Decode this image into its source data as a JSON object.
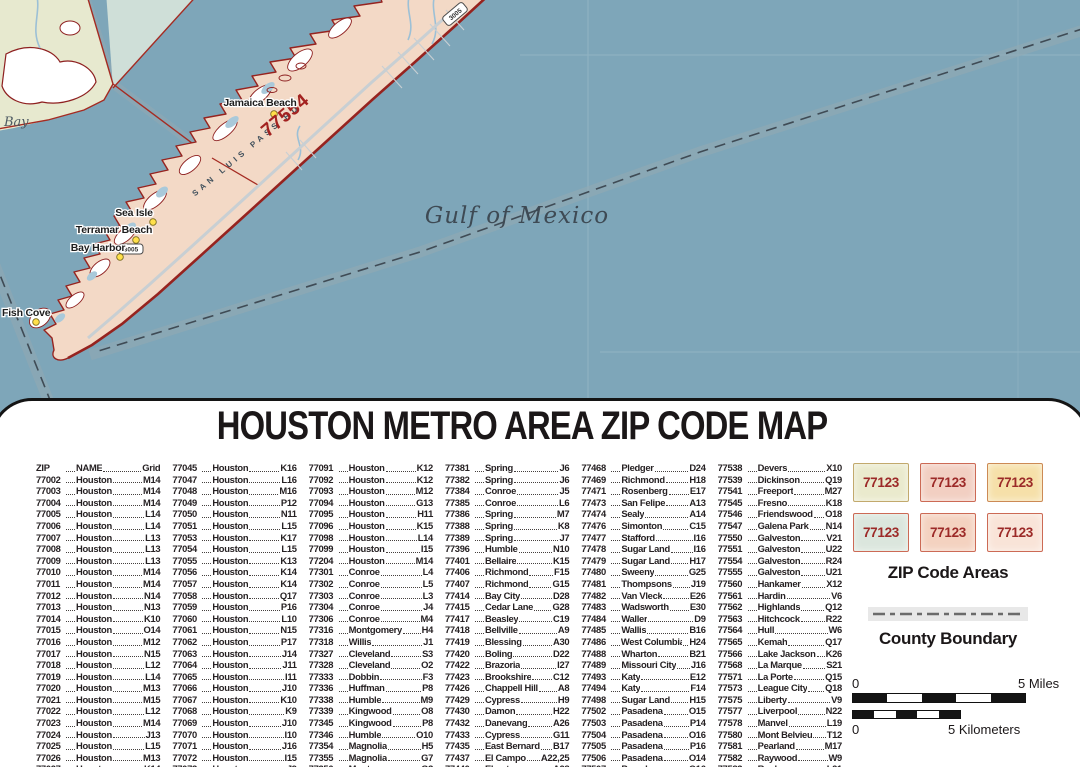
{
  "map": {
    "labels": {
      "gulf": "Gulf of Mexico",
      "bay": "Bay",
      "zip_area": "77554",
      "road": "SAN LUIS PASS RD",
      "route_shield": "3005",
      "towns": [
        "Jamaica Beach",
        "Sea Isle",
        "Terramar Beach",
        "Bay Harbor",
        "Fish Cove"
      ]
    },
    "colors": {
      "water": "#7ea6b9",
      "island": "#f3d9c6",
      "coastline": "#96231f",
      "mainland": "#e7e9cf",
      "bay_overlay": "#cfdfd8"
    }
  },
  "panel": {
    "title": "HOUSTON METRO AREA ZIP CODE MAP"
  },
  "zip_index": {
    "header": {
      "zip": "ZIP",
      "name": "NAME",
      "grid": "Grid"
    },
    "columns": [
      {
        "rows": [
          {
            "zip": "77002",
            "name": "Houston",
            "grid": "M14"
          },
          {
            "zip": "77003",
            "name": "Houston",
            "grid": "M14"
          },
          {
            "zip": "77004",
            "name": "Houston",
            "grid": "M14"
          },
          {
            "zip": "77005",
            "name": "Houston",
            "grid": "L14"
          },
          {
            "zip": "77006",
            "name": "Houston",
            "grid": "L14"
          },
          {
            "zip": "77007",
            "name": "Houston",
            "grid": "L13"
          },
          {
            "zip": "77008",
            "name": "Houston",
            "grid": "L13"
          },
          {
            "zip": "77009",
            "name": "Houston",
            "grid": "L13"
          },
          {
            "zip": "77010",
            "name": "Houston",
            "grid": "M14"
          },
          {
            "zip": "77011",
            "name": "Houston",
            "grid": "M14"
          },
          {
            "zip": "77012",
            "name": "Houston",
            "grid": "N14"
          },
          {
            "zip": "77013",
            "name": "Houston",
            "grid": "N13"
          },
          {
            "zip": "77014",
            "name": "Houston",
            "grid": "K10"
          },
          {
            "zip": "77015",
            "name": "Houston",
            "grid": "O14"
          },
          {
            "zip": "77016",
            "name": "Houston",
            "grid": "M12"
          },
          {
            "zip": "77017",
            "name": "Houston",
            "grid": "N15"
          },
          {
            "zip": "77018",
            "name": "Houston",
            "grid": "L12"
          },
          {
            "zip": "77019",
            "name": "Houston",
            "grid": "L14"
          },
          {
            "zip": "77020",
            "name": "Houston",
            "grid": "M13"
          },
          {
            "zip": "77021",
            "name": "Houston",
            "grid": "M15"
          },
          {
            "zip": "77022",
            "name": "Houston",
            "grid": "L12"
          },
          {
            "zip": "77023",
            "name": "Houston",
            "grid": "M14"
          },
          {
            "zip": "77024",
            "name": "Houston",
            "grid": "J13"
          },
          {
            "zip": "77025",
            "name": "Houston",
            "grid": "L15"
          },
          {
            "zip": "77026",
            "name": "Houston",
            "grid": "M13"
          },
          {
            "zip": "77027",
            "name": "Houston",
            "grid": "K14"
          }
        ]
      },
      {
        "rows": [
          {
            "zip": "77045",
            "name": "Houston",
            "grid": "K16"
          },
          {
            "zip": "77047",
            "name": "Houston",
            "grid": "L16"
          },
          {
            "zip": "77048",
            "name": "Houston",
            "grid": "M16"
          },
          {
            "zip": "77049",
            "name": "Houston",
            "grid": "P12"
          },
          {
            "zip": "77050",
            "name": "Houston",
            "grid": "N11"
          },
          {
            "zip": "77051",
            "name": "Houston",
            "grid": "L15"
          },
          {
            "zip": "77053",
            "name": "Houston",
            "grid": "K17"
          },
          {
            "zip": "77054",
            "name": "Houston",
            "grid": "L15"
          },
          {
            "zip": "77055",
            "name": "Houston",
            "grid": "K13"
          },
          {
            "zip": "77056",
            "name": "Houston",
            "grid": "K14"
          },
          {
            "zip": "77057",
            "name": "Houston",
            "grid": "K14"
          },
          {
            "zip": "77058",
            "name": "Houston",
            "grid": "Q17"
          },
          {
            "zip": "77059",
            "name": "Houston",
            "grid": "P16"
          },
          {
            "zip": "77060",
            "name": "Houston",
            "grid": "L10"
          },
          {
            "zip": "77061",
            "name": "Houston",
            "grid": "N15"
          },
          {
            "zip": "77062",
            "name": "Houston",
            "grid": "P17"
          },
          {
            "zip": "77063",
            "name": "Houston",
            "grid": "J14"
          },
          {
            "zip": "77064",
            "name": "Houston",
            "grid": "J11"
          },
          {
            "zip": "77065",
            "name": "Houston",
            "grid": "I11"
          },
          {
            "zip": "77066",
            "name": "Houston",
            "grid": "J10"
          },
          {
            "zip": "77067",
            "name": "Houston",
            "grid": "K10"
          },
          {
            "zip": "77068",
            "name": "Houston",
            "grid": "K9"
          },
          {
            "zip": "77069",
            "name": "Houston",
            "grid": "J10"
          },
          {
            "zip": "77070",
            "name": "Houston",
            "grid": "I10"
          },
          {
            "zip": "77071",
            "name": "Houston",
            "grid": "J16"
          },
          {
            "zip": "77072",
            "name": "Houston",
            "grid": "I15"
          },
          {
            "zip": "77073",
            "name": "Houston",
            "grid": "J9"
          }
        ]
      },
      {
        "rows": [
          {
            "zip": "77091",
            "name": "Houston",
            "grid": "K12"
          },
          {
            "zip": "77092",
            "name": "Houston",
            "grid": "K12"
          },
          {
            "zip": "77093",
            "name": "Houston",
            "grid": "M12"
          },
          {
            "zip": "77094",
            "name": "Houston",
            "grid": "G13"
          },
          {
            "zip": "77095",
            "name": "Houston",
            "grid": "H11"
          },
          {
            "zip": "77096",
            "name": "Houston",
            "grid": "K15"
          },
          {
            "zip": "77098",
            "name": "Houston",
            "grid": "L14"
          },
          {
            "zip": "77099",
            "name": "Houston",
            "grid": "I15"
          },
          {
            "zip": "77204",
            "name": "Houston",
            "grid": "M14"
          },
          {
            "zip": "77301",
            "name": "Conroe",
            "grid": "L4"
          },
          {
            "zip": "77302",
            "name": "Conroe",
            "grid": "L5"
          },
          {
            "zip": "77303",
            "name": "Conroe",
            "grid": "L3"
          },
          {
            "zip": "77304",
            "name": "Conroe",
            "grid": "J4"
          },
          {
            "zip": "77306",
            "name": "Conroe",
            "grid": "M4"
          },
          {
            "zip": "77316",
            "name": "Montgomery",
            "grid": "H4"
          },
          {
            "zip": "77318",
            "name": "Willis",
            "grid": "J1"
          },
          {
            "zip": "77327",
            "name": "Cleveland",
            "grid": "S3"
          },
          {
            "zip": "77328",
            "name": "Cleveland",
            "grid": "O2"
          },
          {
            "zip": "77333",
            "name": "Dobbin",
            "grid": "F3"
          },
          {
            "zip": "77336",
            "name": "Huffman",
            "grid": "P8"
          },
          {
            "zip": "77338",
            "name": "Humble",
            "grid": "M9"
          },
          {
            "zip": "77339",
            "name": "Kingwood",
            "grid": "O8"
          },
          {
            "zip": "77345",
            "name": "Kingwood",
            "grid": "P8"
          },
          {
            "zip": "77346",
            "name": "Humble",
            "grid": "O10"
          },
          {
            "zip": "77354",
            "name": "Magnolia",
            "grid": "H5"
          },
          {
            "zip": "77355",
            "name": "Magnolia",
            "grid": "G7"
          },
          {
            "zip": "77356",
            "name": "Montgomery",
            "grid": "G3"
          }
        ]
      },
      {
        "rows": [
          {
            "zip": "77381",
            "name": "Spring",
            "grid": "J6"
          },
          {
            "zip": "77382",
            "name": "Spring",
            "grid": "J6"
          },
          {
            "zip": "77384",
            "name": "Conroe",
            "grid": "J5"
          },
          {
            "zip": "77385",
            "name": "Conroe",
            "grid": "L6"
          },
          {
            "zip": "77386",
            "name": "Spring",
            "grid": "M7"
          },
          {
            "zip": "77388",
            "name": "Spring",
            "grid": "K8"
          },
          {
            "zip": "77389",
            "name": "Spring",
            "grid": "J7"
          },
          {
            "zip": "77396",
            "name": "Humble",
            "grid": "N10"
          },
          {
            "zip": "77401",
            "name": "Bellaire",
            "grid": "K15"
          },
          {
            "zip": "77406",
            "name": "Richmond",
            "grid": "F15"
          },
          {
            "zip": "77407",
            "name": "Richmond",
            "grid": "G15"
          },
          {
            "zip": "77414",
            "name": "Bay City",
            "grid": "D28"
          },
          {
            "zip": "77415",
            "name": "Cedar Lane",
            "grid": "G28"
          },
          {
            "zip": "77417",
            "name": "Beasley",
            "grid": "C19"
          },
          {
            "zip": "77418",
            "name": "Bellville",
            "grid": "A9"
          },
          {
            "zip": "77419",
            "name": "Blessing",
            "grid": "A30"
          },
          {
            "zip": "77420",
            "name": "Boling",
            "grid": "D22"
          },
          {
            "zip": "77422",
            "name": "Brazoria",
            "grid": "I27"
          },
          {
            "zip": "77423",
            "name": "Brookshire",
            "grid": "C12"
          },
          {
            "zip": "77426",
            "name": "Chappell Hill",
            "grid": "A8"
          },
          {
            "zip": "77429",
            "name": "Cypress",
            "grid": "H9"
          },
          {
            "zip": "77430",
            "name": "Damon",
            "grid": "H22"
          },
          {
            "zip": "77432",
            "name": "Danevang",
            "grid": "A26"
          },
          {
            "zip": "77433",
            "name": "Cypress",
            "grid": "G11"
          },
          {
            "zip": "77435",
            "name": "East Bernard",
            "grid": "B17"
          },
          {
            "zip": "77437",
            "name": "El Campo",
            "grid": "A22,25"
          },
          {
            "zip": "77440",
            "name": "Elmaton",
            "grid": "A28"
          }
        ]
      },
      {
        "rows": [
          {
            "zip": "77468",
            "name": "Pledger",
            "grid": "D24"
          },
          {
            "zip": "77469",
            "name": "Richmond",
            "grid": "H18"
          },
          {
            "zip": "77471",
            "name": "Rosenberg",
            "grid": "E17"
          },
          {
            "zip": "77473",
            "name": "San Felipe",
            "grid": "A13"
          },
          {
            "zip": "77474",
            "name": "Sealy",
            "grid": "A14"
          },
          {
            "zip": "77476",
            "name": "Simonton",
            "grid": "C15"
          },
          {
            "zip": "77477",
            "name": "Stafford",
            "grid": "I16"
          },
          {
            "zip": "77478",
            "name": "Sugar Land",
            "grid": "I16"
          },
          {
            "zip": "77479",
            "name": "Sugar Land",
            "grid": "H17"
          },
          {
            "zip": "77480",
            "name": "Sweeny",
            "grid": "G25"
          },
          {
            "zip": "77481",
            "name": "Thompsons",
            "grid": "J19"
          },
          {
            "zip": "77482",
            "name": "Van Vleck",
            "grid": "E26"
          },
          {
            "zip": "77483",
            "name": "Wadsworth",
            "grid": "E30"
          },
          {
            "zip": "77484",
            "name": "Waller",
            "grid": "D9"
          },
          {
            "zip": "77485",
            "name": "Wallis",
            "grid": "B16"
          },
          {
            "zip": "77486",
            "name": "West Columbia",
            "grid": "H24"
          },
          {
            "zip": "77488",
            "name": "Wharton",
            "grid": "B21"
          },
          {
            "zip": "77489",
            "name": "Missouri City",
            "grid": "J16"
          },
          {
            "zip": "77493",
            "name": "Katy",
            "grid": "E12"
          },
          {
            "zip": "77494",
            "name": "Katy",
            "grid": "F14"
          },
          {
            "zip": "77498",
            "name": "Sugar Land",
            "grid": "H15"
          },
          {
            "zip": "77502",
            "name": "Pasadena",
            "grid": "O15"
          },
          {
            "zip": "77503",
            "name": "Pasadena",
            "grid": "P14"
          },
          {
            "zip": "77504",
            "name": "Pasadena",
            "grid": "O16"
          },
          {
            "zip": "77505",
            "name": "Pasadena",
            "grid": "P16"
          },
          {
            "zip": "77506",
            "name": "Pasadena",
            "grid": "O14"
          },
          {
            "zip": "77507",
            "name": "Pasadena",
            "grid": "Q16"
          }
        ]
      },
      {
        "rows": [
          {
            "zip": "77538",
            "name": "Devers",
            "grid": "X10"
          },
          {
            "zip": "77539",
            "name": "Dickinson",
            "grid": "Q19"
          },
          {
            "zip": "77541",
            "name": "Freeport",
            "grid": "M27"
          },
          {
            "zip": "77545",
            "name": "Fresno",
            "grid": "K18"
          },
          {
            "zip": "77546",
            "name": "Friendswood",
            "grid": "O18"
          },
          {
            "zip": "77547",
            "name": "Galena Park",
            "grid": "N14"
          },
          {
            "zip": "77550",
            "name": "Galveston",
            "grid": "V21"
          },
          {
            "zip": "77551",
            "name": "Galveston",
            "grid": "U22"
          },
          {
            "zip": "77554",
            "name": "Galveston",
            "grid": "R24"
          },
          {
            "zip": "77555",
            "name": "Galveston",
            "grid": "U21"
          },
          {
            "zip": "77560",
            "name": "Hankamer",
            "grid": "X12"
          },
          {
            "zip": "77561",
            "name": "Hardin",
            "grid": "V6"
          },
          {
            "zip": "77562",
            "name": "Highlands",
            "grid": "Q12"
          },
          {
            "zip": "77563",
            "name": "Hitchcock",
            "grid": "R22"
          },
          {
            "zip": "77564",
            "name": "Hull",
            "grid": "W6"
          },
          {
            "zip": "77565",
            "name": "Kemah",
            "grid": "Q17"
          },
          {
            "zip": "77566",
            "name": "Lake Jackson",
            "grid": "K26"
          },
          {
            "zip": "77568",
            "name": "La Marque",
            "grid": "S21"
          },
          {
            "zip": "77571",
            "name": "La Porte",
            "grid": "Q15"
          },
          {
            "zip": "77573",
            "name": "League City",
            "grid": "Q18"
          },
          {
            "zip": "77575",
            "name": "Liberty",
            "grid": "V9"
          },
          {
            "zip": "77577",
            "name": "Liverpool",
            "grid": "N22"
          },
          {
            "zip": "77578",
            "name": "Manvel",
            "grid": "L19"
          },
          {
            "zip": "77580",
            "name": "Mont Belvieu",
            "grid": "T12"
          },
          {
            "zip": "77581",
            "name": "Pearland",
            "grid": "M17"
          },
          {
            "zip": "77582",
            "name": "Raywood",
            "grid": "W9"
          },
          {
            "zip": "77583",
            "name": "Rosharon",
            "grid": "L21"
          }
        ]
      }
    ]
  },
  "legend": {
    "swatches": [
      {
        "label": "77123",
        "fill": "#eaeacd",
        "border": "#c2a96d"
      },
      {
        "label": "77123",
        "fill": "#f2cfc2",
        "border": "#cc6a55"
      },
      {
        "label": "77123",
        "fill": "#f6e0a9",
        "border": "#cc8a55"
      },
      {
        "label": "77123",
        "fill": "#dbe6dd",
        "border": "#cc6a55"
      },
      {
        "label": "77123",
        "fill": "#f4d2c0",
        "border": "#cc6a55"
      },
      {
        "label": "77123",
        "fill": "#f9e4d8",
        "border": "#cc6a55"
      }
    ],
    "zip_areas_label": "ZIP Code Areas",
    "county_boundary_label": "County Boundary",
    "scale": {
      "zero": "0",
      "miles": "5 Miles",
      "kilometers": "5 Kilometers"
    }
  }
}
